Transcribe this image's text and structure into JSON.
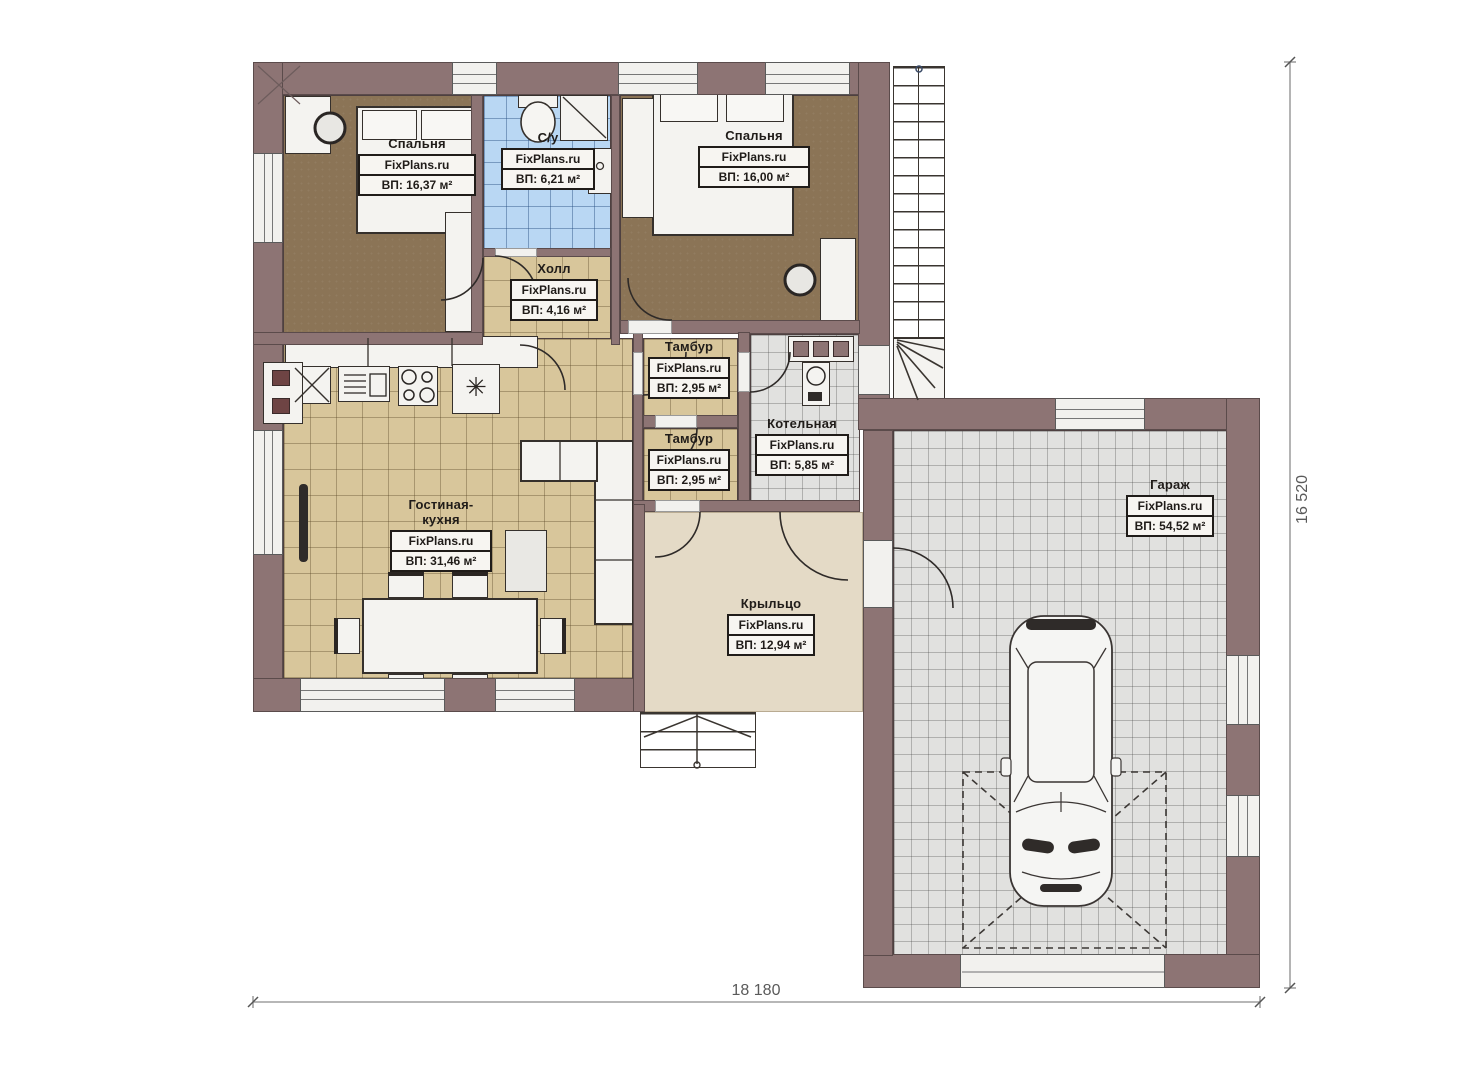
{
  "plan": {
    "watermark": "FixPlans.ru",
    "rooms": [
      {
        "name": "Спальня",
        "area": "ВП: 16,37 м²"
      },
      {
        "name": "С/у",
        "area": "ВП: 6,21 м²"
      },
      {
        "name": "Спальня",
        "area": "ВП: 16,00 м²"
      },
      {
        "name": "Холл",
        "area": "ВП: 4,16 м²"
      },
      {
        "name": "Тамбур",
        "area": "ВП: 2,95 м²"
      },
      {
        "name": "Тамбур",
        "area": "ВП: 2,95 м²"
      },
      {
        "name": "Котельная",
        "area": "ВП: 5,85 м²"
      },
      {
        "name": "Гостиная-кухня",
        "area": "ВП: 31,46 м²"
      },
      {
        "name": "Крыльцо",
        "area": "ВП: 12,94 м²"
      },
      {
        "name": "Гараж",
        "area": "ВП: 54,52 м²"
      }
    ],
    "dimensions": {
      "width_label": "18 180",
      "height_label": "16 520"
    },
    "symbols": {
      "heater": "✳"
    },
    "colors": {
      "wall": "#8d7474",
      "floor_wood": "#8b7456",
      "floor_tile_tan": "#d8c69b",
      "floor_tile_blue": "#b9d7f3",
      "floor_tile_gray": "#e1e1df",
      "floor_porch": "#e4dac6"
    }
  }
}
